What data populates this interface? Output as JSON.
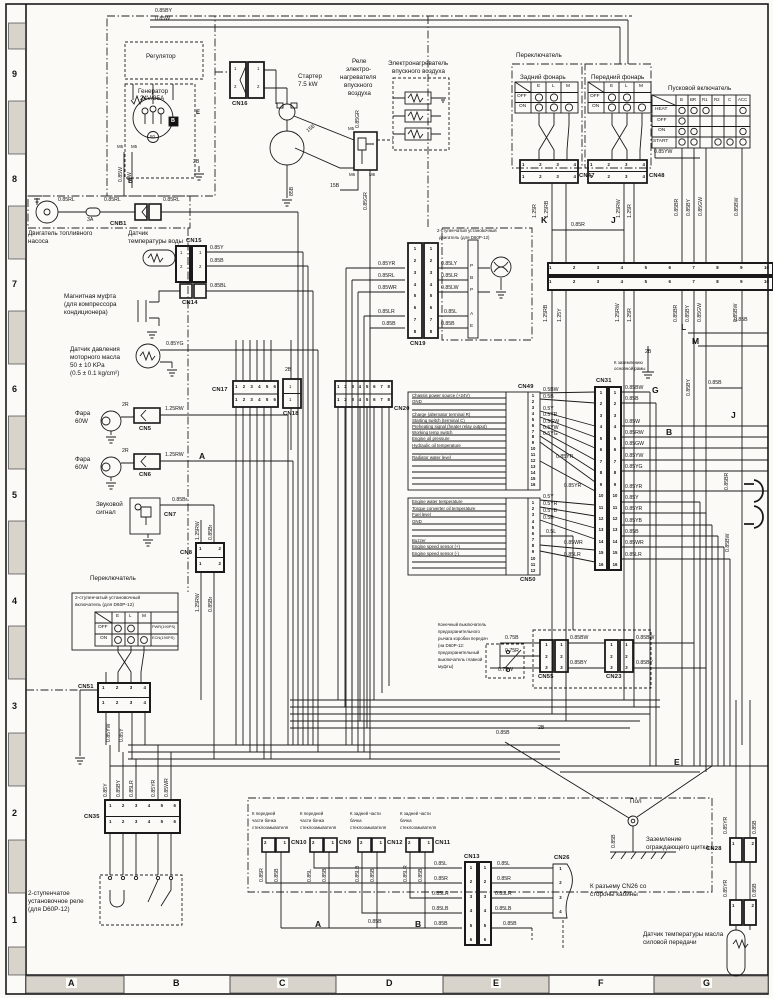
{
  "sheet": {
    "row_labels": [
      "9",
      "8",
      "7",
      "6",
      "5",
      "4",
      "3",
      "2",
      "1"
    ],
    "col_labels": [
      "A",
      "B",
      "C",
      "D",
      "E",
      "F",
      "G"
    ]
  },
  "pins": {
    "p1": [
      "1"
    ],
    "p2": [
      "1",
      "2"
    ],
    "p21": [
      "2",
      "1"
    ],
    "p3": [
      "1",
      "2",
      "3"
    ],
    "p4": [
      "1",
      "2",
      "3",
      "4"
    ],
    "p6": [
      "1",
      "2",
      "3",
      "4",
      "5",
      "6"
    ],
    "p8": [
      "1",
      "2",
      "3",
      "4",
      "5",
      "6",
      "7",
      "8"
    ],
    "p10": [
      "1",
      "2",
      "3",
      "4",
      "5",
      "6",
      "7",
      "8",
      "9",
      "10"
    ],
    "p12": [
      "1",
      "2",
      "3",
      "4",
      "5",
      "6",
      "7",
      "8",
      "9",
      "10",
      "11",
      "12"
    ],
    "p16": [
      "1",
      "2",
      "3",
      "4",
      "5",
      "6",
      "7",
      "8",
      "9",
      "10",
      "11",
      "12",
      "13",
      "14",
      "15",
      "16"
    ]
  },
  "mk": {
    "a": "A",
    "b": "B",
    "e": "E",
    "g": "G",
    "j": "J",
    "k": "K",
    "l": "L",
    "m": "M"
  },
  "wire": {
    "by085": "0.85BY",
    "w085": "0.85W",
    "w8": "8W",
    "b2": "2B",
    "b85": "85B",
    "b15": "15B",
    "gr085": "0.85GR",
    "rl085": "0.85RL",
    "a3": "3A",
    "y085": "0.85Y",
    "b085": "0.85B",
    "bl085": "0.85BL",
    "yg085": "0.85YG",
    "r2": "2R",
    "rw125": "1.25RW",
    "brn085": "0.85Br",
    "rb125": "1.25RB",
    "y125": "1.25Y",
    "r125": "1.25R",
    "r085": "0.85R",
    "br085": "0.85BR",
    "gw085": "0.85GW",
    "bw085": "0.85BW",
    "yw085": "0.85YW",
    "yr085": "0.85YR",
    "wr085": "0.85WR",
    "lr085": "0.85LR",
    "ly085": "0.85LY",
    "lw085": "0.85LW",
    "l085": "0.85L",
    "lb085": "0.85LB",
    "yb085": "0.85YB",
    "rw085": "0.85RW",
    "b075": "0.75B",
    "r075": "0.75R",
    "w075": "0.75W",
    "bw05": "0.5BW",
    "b05": "0.5B",
    "y05": "0.5Y",
    "yr05": "0.5YR",
    "gw05": "0.5GW",
    "yw05": "0.5YW",
    "yg05": "0.5YG",
    "yb05": "0.5YB",
    "l05": "0.5L",
    "m5": "M5",
    "m6": "M6",
    "v50": "50"
  },
  "conn": {
    "cn5": "CN5",
    "cn6": "CN6",
    "cn7": "CN7",
    "cn8": "CN8",
    "cn9": "CN9",
    "cn10": "CN10",
    "cn11": "CN11",
    "cn12": "CN12",
    "cn13": "CN13",
    "cn14": "CN14",
    "cn15": "CN15",
    "cn16": "CN16",
    "cn17": "CN17",
    "cn18": "CN18",
    "cn19": "CN19",
    "cn20": "CN20",
    "cn23": "CN23",
    "cn26": "CN26",
    "cn28": "CN28",
    "cn31": "CN31",
    "cn35": "CN35",
    "cn47": "CN47",
    "cn48": "CN48",
    "cn49": "CN49",
    "cn50": "CN50",
    "cn51": "CN51",
    "cn55": "CN55",
    "cnb1": "CNB1"
  },
  "txt": {
    "regulator": "Регулятор",
    "generator1": "Генератор",
    "generator2": "24V/35A",
    "starter1": "Стартер",
    "starter2": "7.5 kW",
    "relay1": "Реле",
    "relay2": "электро-",
    "relay3": "нагревателя",
    "relay4": "впускного",
    "relay5": "воздуха",
    "heater1": "Электронагреватель",
    "heater2": "впускного воздуха",
    "switch": "Переключатель",
    "rear_lamp": "Задний фонарь",
    "front_lamp": "Передний фонарь",
    "start_switch": "Пусковой включатель",
    "fuel1": "Двигатель топливного",
    "fuel2": "насоса",
    "wtemp1": "Датчик",
    "wtemp2": "температуры воды",
    "mag1": "Магнитная муфта",
    "mag2": "(для компрессора",
    "mag3": "кондиционера)",
    "oilp1": "Датчик давления",
    "oilp2": "моторного масла",
    "oilp3": "50 ± 10 KPa",
    "oilp4": "(0.5 ± 0.1 kg/cm²)",
    "fara": "Фара",
    "w60": "60W",
    "horn1": "Звуковой",
    "horn2": "сигнал",
    "setsw1": "2-ступенчатый установочный",
    "setsw2": "включатель (для D60P-12)",
    "pwr": "PWR(190PS)",
    "ecn": "ECN(190PS)",
    "setmot1": "2-ступенчатый установочный",
    "setmot2": "двигатель (для D60P-12)",
    "setrel1": "2-ступенчатое",
    "setrel2": "установочное реле",
    "setrel3": "(для D60P-12)",
    "limit1": "Конечный выключатель",
    "limit2": "предохранительного",
    "limit3": "рычага коробки передач",
    "limit4": "(на D60P-12:",
    "limit5": "предохранительный",
    "limit6": "выключатель главной",
    "limit7": "муфты)",
    "washf1": "К передней",
    "washf2": "части бачка",
    "washf3": "стеклоомывателя",
    "washr1": "К задней части",
    "washr2": "бачка",
    "washr3": "стеклоомывателя",
    "pol": "Пол",
    "shield1": "Заземление",
    "shield2": "ограждающего щитка",
    "cabnote1": "К разъему CN26 со",
    "cabnote2": "стороны кабины",
    "oiltemp1": "Датчик температуры масла",
    "oiltemp2": "силовой передачи",
    "fgnd1": "К заземлению",
    "fgnd2": "основной рамы"
  },
  "lamp_cols": [
    "E",
    "L",
    "M"
  ],
  "lamp_rows": [
    "OFF",
    "ON"
  ],
  "ss_cols": [
    "B",
    "BR",
    "R1",
    "R2",
    "C",
    "ACC"
  ],
  "ss_rows": [
    "HEAT",
    "OFF",
    "ON",
    "START"
  ],
  "term": {
    "t1": "P",
    "t2": "B",
    "t3": "P",
    "t4": "A",
    "t5": "E"
  },
  "cn49": {
    "r1": "Chassis power source (+24V)",
    "r2": "GND",
    "r4": "Charge (alternator terminal R)",
    "r5": "Starting switch (terminal C)",
    "r6": "Preheating signal (heater relay output)",
    "r7": "Working temp switch",
    "r8": "Engine oil pressure",
    "r9": "Hydraulic oil temperature",
    "r11": "Radiator water level"
  },
  "cn50": {
    "r1": "Engine water temperature",
    "r2": "Torque converter oil temperature",
    "r3": "Fuel level",
    "r4": "GND",
    "r7": "Buzzer",
    "r8": "Engine speed sensor (+)",
    "r9": "Engine speed sensor (-)"
  }
}
